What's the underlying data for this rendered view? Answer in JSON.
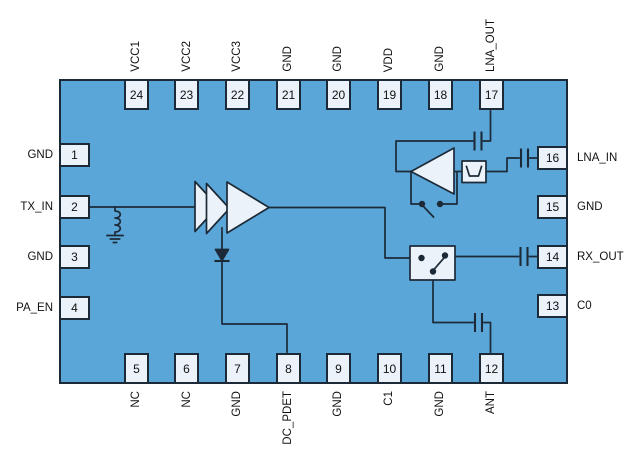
{
  "diagram": {
    "title": "RF front-end module pinout block diagram",
    "pins": {
      "top": [
        {
          "num": "24",
          "label": "VCC1"
        },
        {
          "num": "23",
          "label": "VCC2"
        },
        {
          "num": "22",
          "label": "VCC3"
        },
        {
          "num": "21",
          "label": "GND"
        },
        {
          "num": "20",
          "label": "GND"
        },
        {
          "num": "19",
          "label": "VDD"
        },
        {
          "num": "18",
          "label": "GND"
        },
        {
          "num": "17",
          "label": "LNA_OUT"
        }
      ],
      "bottom": [
        {
          "num": "5",
          "label": "NC"
        },
        {
          "num": "6",
          "label": "NC"
        },
        {
          "num": "7",
          "label": "GND"
        },
        {
          "num": "8",
          "label": "DC_PDET"
        },
        {
          "num": "9",
          "label": "GND"
        },
        {
          "num": "10",
          "label": "C1"
        },
        {
          "num": "11",
          "label": "GND"
        },
        {
          "num": "12",
          "label": "ANT"
        }
      ],
      "left": [
        {
          "num": "1",
          "label": "GND"
        },
        {
          "num": "2",
          "label": "TX_IN"
        },
        {
          "num": "3",
          "label": "GND"
        },
        {
          "num": "4",
          "label": "PA_EN"
        }
      ],
      "right": [
        {
          "num": "16",
          "label": "LNA_IN"
        },
        {
          "num": "15",
          "label": "GND"
        },
        {
          "num": "14",
          "label": "RX_OUT"
        },
        {
          "num": "13",
          "label": "C0"
        }
      ]
    },
    "symbols": [
      "pa-amplifier-icon",
      "lna-amplifier-icon",
      "power-detector-diode-icon",
      "trx-switch-icon",
      "lna-bypass-switch-icon",
      "shunt-inductor-icon",
      "ground-icon",
      "filter-icon",
      "coupling-capacitor-icon"
    ],
    "colors": {
      "chip_fill": "#5ba6d9",
      "pin_fill": "#ebf2f9",
      "line": "#1c2a38",
      "text": "#111111",
      "page": "#ffffff"
    }
  }
}
